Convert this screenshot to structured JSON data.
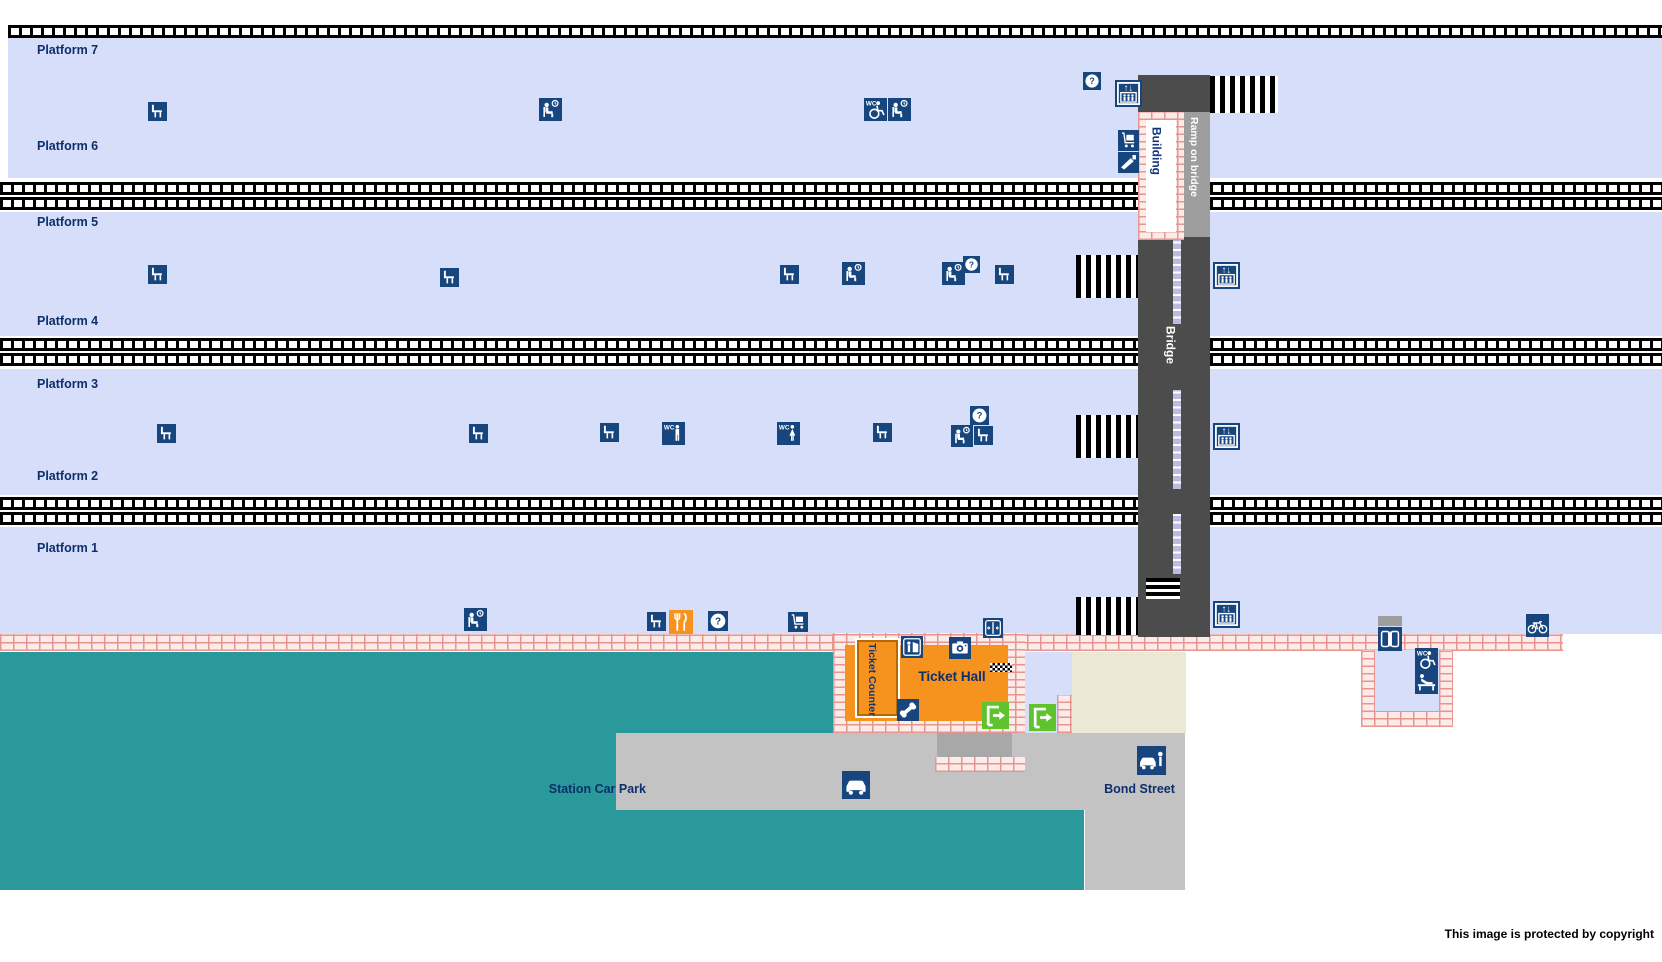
{
  "canvas": {
    "w": 1662,
    "h": 962
  },
  "colors": {
    "platform": "#d6def9",
    "navy": "#17467f",
    "label": "#0d2f6b",
    "teal": "#2a999b",
    "road": "#c3c3c3",
    "road_dark": "#a8a8a8",
    "beige": "#ebe8d6",
    "bridge": "#4c4c4c",
    "ramp": "#9e9e9e",
    "orange": "#f6921e",
    "green": "#5fc32d"
  },
  "icon_text": {
    "wc": "WC",
    "question": "?",
    "lift_arrows": "↑↓"
  },
  "icon_names": {
    "bench": "bench-icon",
    "waiting": "waiting-room-icon",
    "wc_access": "accessible-toilet-icon",
    "wc_men": "mens-toilet-icon",
    "wc_women": "womens-toilet-icon",
    "help": "help-point-icon",
    "lift": "lift-icon",
    "trolley": "luggage-trolley-icon",
    "gates": "ticket-gates-icon",
    "barrier": "ticket-barrier-icon",
    "refresh": "refreshments-icon",
    "machine": "ticket-machine-icon",
    "camera": "photo-booth-icon",
    "phone": "telephone-icon",
    "exit": "entrance-exit-icon",
    "car": "car-park-icon",
    "pickup": "pick-up-point-icon",
    "doors": "entrance-doors-icon",
    "bicycle": "cycle-storage-icon",
    "baby": "baby-change-icon"
  },
  "rects": [
    {
      "name": "platform-7-6-band",
      "k": "platform",
      "x": 8,
      "y": 38,
      "w": 1654,
      "h": 140
    },
    {
      "name": "platform-5-4-band",
      "k": "platform",
      "x": 0,
      "y": 212,
      "w": 1662,
      "h": 124
    },
    {
      "name": "platform-3-2-band",
      "k": "platform",
      "x": 0,
      "y": 369,
      "w": 1662,
      "h": 126
    },
    {
      "name": "platform-1-band",
      "k": "platform",
      "x": 0,
      "y": 527,
      "w": 1662,
      "h": 107
    },
    {
      "name": "track-1",
      "k": "track",
      "x": 8,
      "y": 25,
      "w": 1654,
      "h": 13
    },
    {
      "name": "track-2",
      "k": "track",
      "x": 0,
      "y": 182,
      "w": 1662,
      "h": 13
    },
    {
      "name": "track-3",
      "k": "track",
      "x": 0,
      "y": 197,
      "w": 1662,
      "h": 13
    },
    {
      "name": "track-4",
      "k": "track",
      "x": 0,
      "y": 338,
      "w": 1662,
      "h": 13
    },
    {
      "name": "track-5",
      "k": "track",
      "x": 0,
      "y": 353,
      "w": 1662,
      "h": 13
    },
    {
      "name": "track-6",
      "k": "track",
      "x": 0,
      "y": 497,
      "w": 1662,
      "h": 13
    },
    {
      "name": "track-7",
      "k": "track",
      "x": 0,
      "y": 512,
      "w": 1662,
      "h": 13
    },
    {
      "name": "green-area-upper",
      "k": "teal",
      "x": 0,
      "y": 652,
      "w": 840,
      "h": 81
    },
    {
      "name": "green-area-left",
      "k": "teal",
      "x": 0,
      "y": 733,
      "w": 616,
      "h": 157
    },
    {
      "name": "green-area-lower",
      "k": "teal",
      "x": 0,
      "y": 810,
      "w": 1084,
      "h": 80
    },
    {
      "name": "car-park-road",
      "k": "road",
      "x": 616,
      "y": 733,
      "w": 569,
      "h": 77
    },
    {
      "name": "bond-street-road",
      "k": "road",
      "x": 1085,
      "y": 733,
      "w": 100,
      "h": 157
    },
    {
      "name": "hall-rear-path",
      "k": "road_dark",
      "x": 937,
      "y": 733,
      "w": 75,
      "h": 24
    },
    {
      "name": "station-forecourt",
      "k": "beige",
      "x": 1072,
      "y": 652,
      "w": 114,
      "h": 81
    },
    {
      "name": "hall-side-corridor",
      "k": "platform",
      "x": 1025,
      "y": 652,
      "w": 47,
      "h": 81
    },
    {
      "name": "main-platform-wall",
      "k": "brick",
      "x": 0,
      "y": 634,
      "w": 1563,
      "h": 17
    },
    {
      "name": "ticket-hall-outer-wall",
      "k": "brick",
      "x": 833,
      "y": 633,
      "w": 192,
      "h": 100
    },
    {
      "name": "hall-rear-wall",
      "k": "brick",
      "x": 935,
      "y": 757,
      "w": 90,
      "h": 15
    },
    {
      "name": "corridor-side-wall",
      "k": "brick",
      "x": 1057,
      "y": 695,
      "w": 15,
      "h": 38
    },
    {
      "name": "toilet-block-interior",
      "k": "platform",
      "x": 1375,
      "y": 650,
      "w": 64,
      "h": 61
    },
    {
      "name": "toilet-block-left-wall",
      "k": "brick",
      "x": 1361,
      "y": 650,
      "w": 14,
      "h": 77
    },
    {
      "name": "toilet-block-right-wall",
      "k": "brick",
      "x": 1439,
      "y": 650,
      "w": 14,
      "h": 77
    },
    {
      "name": "toilet-block-bottom-wall",
      "k": "brick",
      "x": 1361,
      "y": 711,
      "w": 92,
      "h": 16
    },
    {
      "name": "footbridge",
      "k": "bridge",
      "x": 1138,
      "y": 75,
      "w": 72,
      "h": 562
    },
    {
      "name": "bridge-ramp-strip",
      "k": "ramp",
      "x": 1183,
      "y": 112,
      "w": 27,
      "h": 125
    },
    {
      "name": "stairs-bridge-top",
      "k": "stairs",
      "x": 1210,
      "y": 76,
      "w": 68,
      "h": 37
    },
    {
      "name": "stairs-platform-5",
      "k": "stairs",
      "x": 1076,
      "y": 255,
      "w": 62,
      "h": 43
    },
    {
      "name": "stairs-platform-3",
      "k": "stairs",
      "x": 1076,
      "y": 415,
      "w": 62,
      "h": 43
    },
    {
      "name": "stairs-platform-1",
      "k": "stairs",
      "x": 1076,
      "y": 597,
      "w": 62,
      "h": 38
    },
    {
      "name": "bridge-bottom-steps",
      "k": "steps",
      "x": 1146,
      "y": 578,
      "w": 34,
      "h": 21
    },
    {
      "name": "bridge-ramp-segment-1",
      "k": "strip",
      "x": 1173,
      "y": 240,
      "w": 8,
      "h": 84
    },
    {
      "name": "bridge-ramp-segment-2",
      "k": "strip",
      "x": 1173,
      "y": 390,
      "w": 8,
      "h": 99
    },
    {
      "name": "bridge-ramp-segment-3",
      "k": "strip",
      "x": 1173,
      "y": 514,
      "w": 8,
      "h": 60
    },
    {
      "name": "building-wall",
      "k": "brick",
      "x": 1138,
      "y": 112,
      "w": 46,
      "h": 128
    },
    {
      "name": "building-interior",
      "k": "#ffffff",
      "x": 1146,
      "y": 120,
      "w": 30,
      "h": 112
    },
    {
      "name": "ticket-hall-floor",
      "k": "orange",
      "x": 845,
      "y": 645,
      "w": 163,
      "h": 76
    },
    {
      "name": "ticket-counter-box",
      "k": "orange",
      "x": 857,
      "y": 640,
      "w": 41,
      "h": 76,
      "border": "2px solid #b36a00",
      "shadow": "0 0 0 2px #ffffff"
    },
    {
      "name": "hall-ramp-mat",
      "k": "checker",
      "x": 990,
      "y": 663,
      "w": 22,
      "h": 9
    },
    {
      "name": "toilet-doorway-canopy",
      "k": "ramp",
      "x": 1378,
      "y": 616,
      "w": 24,
      "h": 10
    }
  ],
  "icons": [
    {
      "t": "bench",
      "x": 148,
      "y": 102,
      "s": 19
    },
    {
      "t": "waiting",
      "x": 539,
      "y": 98,
      "s": 23
    },
    {
      "t": "wc_access",
      "x": 864,
      "y": 98,
      "s": 23
    },
    {
      "t": "waiting",
      "x": 888,
      "y": 98,
      "s": 23
    },
    {
      "t": "help",
      "x": 1083,
      "y": 72,
      "s": 18
    },
    {
      "t": "lift",
      "x": 1115,
      "y": 80,
      "s": 27
    },
    {
      "t": "trolley",
      "x": 1118,
      "y": 130,
      "s": 21
    },
    {
      "t": "gates",
      "x": 1118,
      "y": 152,
      "s": 21
    },
    {
      "t": "bench",
      "x": 148,
      "y": 265,
      "s": 19
    },
    {
      "t": "bench",
      "x": 440,
      "y": 268,
      "s": 19
    },
    {
      "t": "bench",
      "x": 780,
      "y": 265,
      "s": 19
    },
    {
      "t": "waiting",
      "x": 842,
      "y": 262,
      "s": 23
    },
    {
      "t": "waiting",
      "x": 942,
      "y": 262,
      "s": 23
    },
    {
      "t": "help",
      "x": 963,
      "y": 256,
      "s": 17
    },
    {
      "t": "bench",
      "x": 995,
      "y": 265,
      "s": 19
    },
    {
      "t": "lift",
      "x": 1213,
      "y": 262,
      "s": 27
    },
    {
      "t": "bench",
      "x": 157,
      "y": 424,
      "s": 19
    },
    {
      "t": "bench",
      "x": 469,
      "y": 424,
      "s": 19
    },
    {
      "t": "bench",
      "x": 600,
      "y": 423,
      "s": 19
    },
    {
      "t": "wc_men",
      "x": 662,
      "y": 422,
      "s": 23
    },
    {
      "t": "wc_women",
      "x": 777,
      "y": 422,
      "s": 23
    },
    {
      "t": "bench",
      "x": 873,
      "y": 423,
      "s": 19
    },
    {
      "t": "help",
      "x": 970,
      "y": 406,
      "s": 19
    },
    {
      "t": "waiting",
      "x": 951,
      "y": 425,
      "s": 22
    },
    {
      "t": "bench",
      "x": 974,
      "y": 426,
      "s": 19
    },
    {
      "t": "lift",
      "x": 1213,
      "y": 423,
      "s": 27
    },
    {
      "t": "waiting",
      "x": 464,
      "y": 608,
      "s": 23
    },
    {
      "t": "bench",
      "x": 647,
      "y": 612,
      "s": 19
    },
    {
      "t": "refresh",
      "x": 669,
      "y": 610,
      "s": 24
    },
    {
      "t": "help",
      "x": 708,
      "y": 611,
      "s": 20
    },
    {
      "t": "trolley",
      "x": 788,
      "y": 612,
      "s": 20
    },
    {
      "t": "barrier",
      "x": 983,
      "y": 618,
      "s": 20
    },
    {
      "t": "lift",
      "x": 1213,
      "y": 601,
      "s": 27
    },
    {
      "t": "bicycle",
      "x": 1526,
      "y": 614,
      "s": 23
    },
    {
      "t": "machine",
      "x": 901,
      "y": 636,
      "s": 22
    },
    {
      "t": "camera",
      "x": 949,
      "y": 637,
      "s": 22
    },
    {
      "t": "phone",
      "x": 897,
      "y": 699,
      "s": 22
    },
    {
      "t": "exit",
      "x": 982,
      "y": 702,
      "s": 27
    },
    {
      "t": "exit",
      "x": 1029,
      "y": 704,
      "s": 27
    },
    {
      "t": "car",
      "x": 842,
      "y": 771,
      "s": 28
    },
    {
      "t": "pickup",
      "x": 1137,
      "y": 746,
      "s": 29
    },
    {
      "t": "doors",
      "x": 1378,
      "y": 627,
      "s": 24
    },
    {
      "t": "wc_access",
      "x": 1415,
      "y": 648,
      "s": 23
    },
    {
      "t": "baby",
      "x": 1415,
      "y": 671,
      "s": 23
    }
  ],
  "texts": [
    {
      "name": "platform-7",
      "text": "Platform 7",
      "x": 37,
      "y": 44,
      "size": 12.5
    },
    {
      "name": "platform-6",
      "text": "Platform 6",
      "x": 37,
      "y": 140,
      "size": 12.5
    },
    {
      "name": "platform-5",
      "text": "Platform 5",
      "x": 37,
      "y": 216,
      "size": 12.5
    },
    {
      "name": "platform-4",
      "text": "Platform 4",
      "x": 37,
      "y": 315,
      "size": 12.5
    },
    {
      "name": "platform-3",
      "text": "Platform 3",
      "x": 37,
      "y": 378,
      "size": 12.5
    },
    {
      "name": "platform-2",
      "text": "Platform 2",
      "x": 37,
      "y": 470,
      "size": 12.5
    },
    {
      "name": "platform-1",
      "text": "Platform 1",
      "x": 37,
      "y": 542,
      "size": 12.5
    },
    {
      "name": "bridge",
      "text": "Bridge",
      "x": 1164,
      "y": 326,
      "vertical": true,
      "color": "#ffffff",
      "size": 12
    },
    {
      "name": "ramp-on-bridge",
      "text": "Ramp on bridge",
      "x": 1188,
      "y": 117,
      "vertical": true,
      "color": "#ffffff",
      "size": 10.5
    },
    {
      "name": "building",
      "text": "Building",
      "x": 1150,
      "y": 127,
      "vertical": true,
      "color": "#14357c",
      "size": 12
    },
    {
      "name": "ticket-counter",
      "text": "Ticket Counter",
      "x": 866,
      "y": 643,
      "vertical": true,
      "color": "#14357c",
      "size": 10.5
    },
    {
      "name": "ticket-hall",
      "text": "Ticket Hall",
      "x": 900,
      "y": 670,
      "w": 104,
      "align": "center",
      "size": 13.5
    },
    {
      "name": "station-car-park",
      "text": "Station Car Park",
      "x": 518,
      "y": 783,
      "w": 128,
      "align": "right",
      "size": 12.5
    },
    {
      "name": "bond-street",
      "text": "Bond Street",
      "x": 1092,
      "y": 783,
      "w": 95,
      "align": "center",
      "size": 12.5
    },
    {
      "name": "copyright",
      "text": "This image is protected by copyright",
      "x": 1374,
      "y": 928,
      "w": 280,
      "align": "right",
      "size": 12,
      "color": "#000000"
    }
  ]
}
